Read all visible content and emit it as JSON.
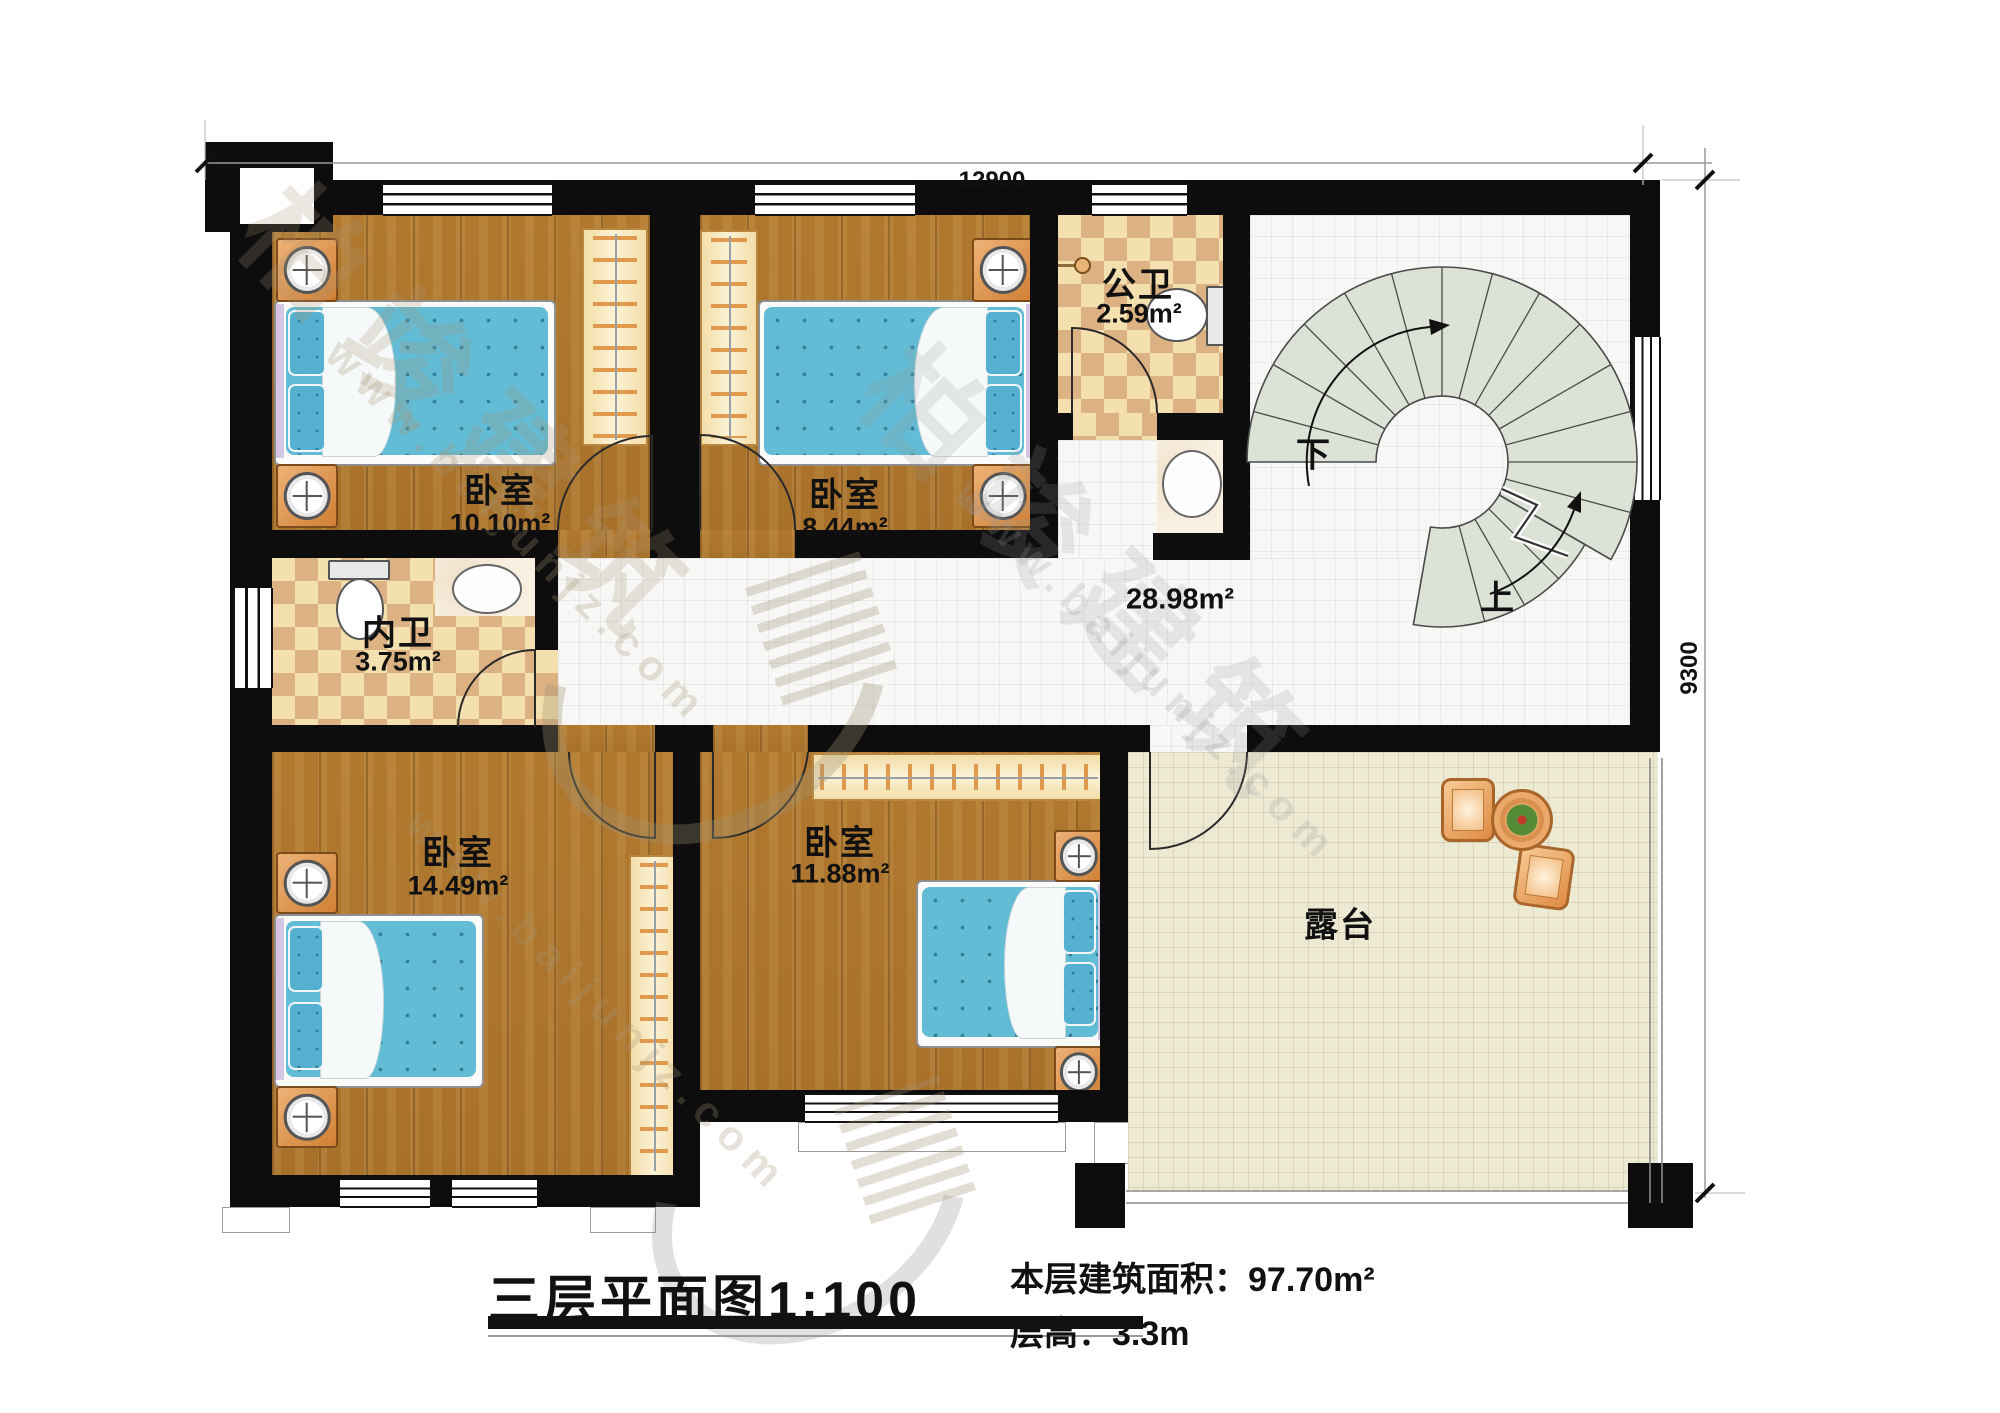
{
  "plan": {
    "title": "三层平面图1:100",
    "stats": {
      "area_label": "本层建筑面积：",
      "area_value": "97.70m²",
      "height_label": "层高：",
      "height_value": "3.3m"
    },
    "dimensions": {
      "top": "12900",
      "right": "9300"
    },
    "rooms": {
      "bedroom_tl": {
        "name": "卧室",
        "area": "10.10m²"
      },
      "bedroom_tm": {
        "name": "卧室",
        "area": "8.44m²"
      },
      "bath_public": {
        "name": "公卫",
        "area": "2.59m²"
      },
      "bath_private": {
        "name": "内卫",
        "area": "3.75m²"
      },
      "bedroom_bl": {
        "name": "卧室",
        "area": "14.49m²"
      },
      "bedroom_bm": {
        "name": "卧室",
        "area": "11.88m²"
      },
      "hallway": {
        "area": "28.98m²"
      },
      "terrace": {
        "name": "露台"
      }
    },
    "stairs": {
      "down": "下",
      "up": "上"
    },
    "watermark": {
      "brand": "柏竣建筑",
      "url": "www.baijunjz.com"
    },
    "colors": {
      "wall": "#0d0d0d",
      "wood_floor": "#b1792f",
      "bath_tile_light": "#f4dfae",
      "bath_tile_dark": "#dcb283",
      "hall_tile": "#f7f7f6",
      "terrace_tile": "#edead4",
      "bed_blue": "#62bcd6",
      "furniture_orange": "#d98a4c",
      "stair_fill": "#dce3d6"
    }
  }
}
